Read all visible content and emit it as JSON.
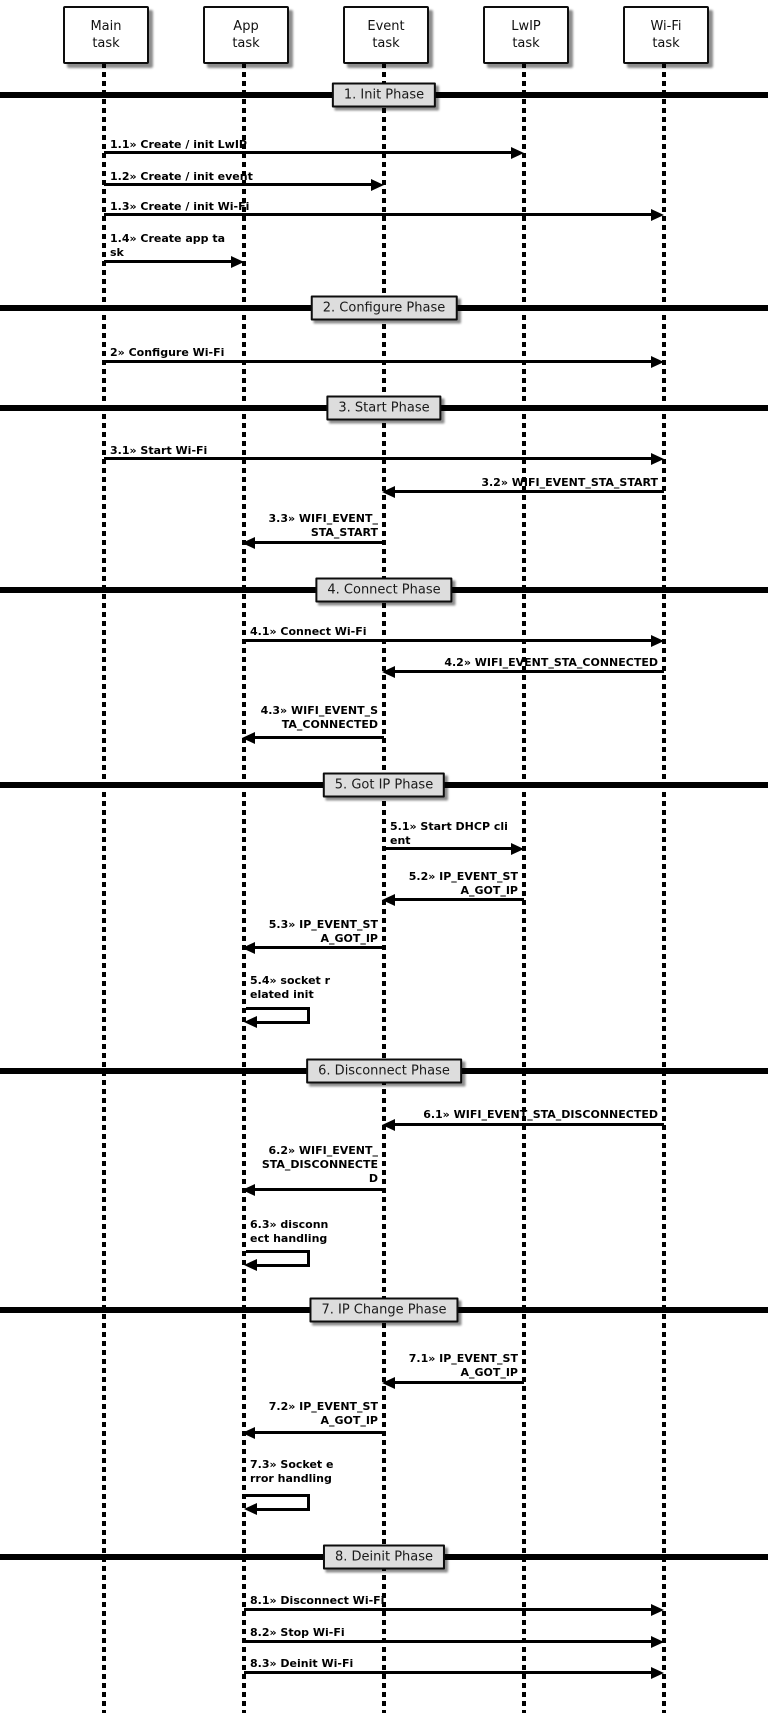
{
  "diagram_type": "uml-sequence-diagram",
  "colors": {
    "line": "#000000",
    "actor_box_bg": "#ffffff",
    "phase_box_bg": "#dddddd",
    "text": "#000000",
    "background": "#ffffff"
  },
  "actors": [
    {
      "id": "main-task",
      "lines": [
        "Main",
        "task"
      ]
    },
    {
      "id": "app-task",
      "lines": [
        "App",
        "task"
      ]
    },
    {
      "id": "event-task",
      "lines": [
        "Event",
        "task"
      ]
    },
    {
      "id": "lwip-task",
      "lines": [
        "LwIP",
        "task"
      ]
    },
    {
      "id": "wifi-task",
      "lines": [
        "Wi-Fi",
        "task"
      ]
    }
  ],
  "phases": [
    {
      "label": "1. Init Phase"
    },
    {
      "label": "2. Configure Phase"
    },
    {
      "label": "3. Start Phase"
    },
    {
      "label": "4. Connect Phase"
    },
    {
      "label": "5. Got IP Phase"
    },
    {
      "label": "6. Disconnect Phase"
    },
    {
      "label": "7. IP Change Phase"
    },
    {
      "label": "8. Deinit Phase"
    }
  ],
  "messages": [
    {
      "num": "1.1",
      "text": "1.1» Create / init LwIP",
      "lines": [
        "1.1» Create / init LwIP"
      ],
      "from": "Main task",
      "to": "LwIP task",
      "kind": "call"
    },
    {
      "num": "1.2",
      "text": "1.2» Create / init event",
      "lines": [
        "1.2» Create / init event"
      ],
      "from": "Main task",
      "to": "Event task",
      "kind": "call"
    },
    {
      "num": "1.3",
      "text": "1.3» Create / init Wi-Fi",
      "lines": [
        "1.3» Create / init Wi-Fi"
      ],
      "from": "Main task",
      "to": "Wi-Fi task",
      "kind": "call"
    },
    {
      "num": "1.4",
      "text": "1.4» Create app task",
      "lines": [
        "1.4» Create app ta",
        "sk"
      ],
      "from": "Main task",
      "to": "App task",
      "kind": "call"
    },
    {
      "num": "2",
      "text": "2» Configure Wi-Fi",
      "lines": [
        "2» Configure Wi-Fi"
      ],
      "from": "Main task",
      "to": "Wi-Fi task",
      "kind": "call"
    },
    {
      "num": "3.1",
      "text": "3.1» Start Wi-Fi",
      "lines": [
        "3.1» Start Wi-Fi"
      ],
      "from": "Main task",
      "to": "Wi-Fi task",
      "kind": "call"
    },
    {
      "num": "3.2",
      "text": "3.2» WIFI_EVENT_STA_START",
      "lines": [
        "3.2» WIFI_EVENT_STA_START"
      ],
      "from": "Wi-Fi task",
      "to": "Event task",
      "kind": "event"
    },
    {
      "num": "3.3",
      "text": "3.3» WIFI_EVENT_STA_START",
      "lines": [
        "3.3» WIFI_EVENT_",
        "STA_START"
      ],
      "from": "Event task",
      "to": "App task",
      "kind": "event"
    },
    {
      "num": "4.1",
      "text": "4.1» Connect Wi-Fi",
      "lines": [
        "4.1» Connect Wi-Fi"
      ],
      "from": "App task",
      "to": "Wi-Fi task",
      "kind": "call"
    },
    {
      "num": "4.2",
      "text": "4.2» WIFI_EVENT_STA_CONNECTED",
      "lines": [
        "4.2» WIFI_EVENT_STA_CONNECTED"
      ],
      "from": "Wi-Fi task",
      "to": "Event task",
      "kind": "event"
    },
    {
      "num": "4.3",
      "text": "4.3» WIFI_EVENT_STA_CONNECTED",
      "lines": [
        "4.3» WIFI_EVENT_S",
        "TA_CONNECTED"
      ],
      "from": "Event task",
      "to": "App task",
      "kind": "event"
    },
    {
      "num": "5.1",
      "text": "5.1» Start DHCP client",
      "lines": [
        "5.1» Start DHCP cli",
        "ent"
      ],
      "from": "Event task",
      "to": "LwIP task",
      "kind": "call"
    },
    {
      "num": "5.2",
      "text": "5.2» IP_EVENT_STA_GOT_IP",
      "lines": [
        "5.2» IP_EVENT_ST",
        "A_GOT_IP"
      ],
      "from": "LwIP task",
      "to": "Event task",
      "kind": "event"
    },
    {
      "num": "5.3",
      "text": "5.3» IP_EVENT_STA_GOT_IP",
      "lines": [
        "5.3» IP_EVENT_ST",
        "A_GOT_IP"
      ],
      "from": "Event task",
      "to": "App task",
      "kind": "event"
    },
    {
      "num": "5.4",
      "text": "5.4» socket related init",
      "lines": [
        "5.4» socket r",
        "elated init"
      ],
      "from": "App task",
      "to": "App task",
      "kind": "self"
    },
    {
      "num": "6.1",
      "text": "6.1» WIFI_EVENT_STA_DISCONNECTED",
      "lines": [
        "6.1» WIFI_EVENT_STA_DISCONNECTED"
      ],
      "from": "Wi-Fi task",
      "to": "Event task",
      "kind": "event"
    },
    {
      "num": "6.2",
      "text": "6.2» WIFI_EVENT_STA_DISCONNECTED",
      "lines": [
        "6.2» WIFI_EVENT_",
        "STA_DISCONNECTE",
        "D"
      ],
      "from": "Event task",
      "to": "App task",
      "kind": "event"
    },
    {
      "num": "6.3",
      "text": "6.3» disconnect handling",
      "lines": [
        "6.3» disconn",
        "ect handling"
      ],
      "from": "App task",
      "to": "App task",
      "kind": "self"
    },
    {
      "num": "7.1",
      "text": "7.1» IP_EVENT_STA_GOT_IP",
      "lines": [
        "7.1» IP_EVENT_ST",
        "A_GOT_IP"
      ],
      "from": "LwIP task",
      "to": "Event task",
      "kind": "event"
    },
    {
      "num": "7.2",
      "text": "7.2» IP_EVENT_STA_GOT_IP",
      "lines": [
        "7.2» IP_EVENT_ST",
        "A_GOT_IP"
      ],
      "from": "Event task",
      "to": "App task",
      "kind": "event"
    },
    {
      "num": "7.3",
      "text": "7.3» Socket error handling",
      "lines": [
        "7.3» Socket e",
        "rror handling"
      ],
      "from": "App task",
      "to": "App task",
      "kind": "self"
    },
    {
      "num": "8.1",
      "text": "8.1» Disconnect Wi-Fi",
      "lines": [
        "8.1» Disconnect Wi-Fi"
      ],
      "from": "App task",
      "to": "Wi-Fi task",
      "kind": "call"
    },
    {
      "num": "8.2",
      "text": "8.2» Stop Wi-Fi",
      "lines": [
        "8.2» Stop Wi-Fi"
      ],
      "from": "App task",
      "to": "Wi-Fi task",
      "kind": "call"
    },
    {
      "num": "8.3",
      "text": "8.3» Deinit Wi-Fi",
      "lines": [
        "8.3» Deinit Wi-Fi"
      ],
      "from": "App task",
      "to": "Wi-Fi task",
      "kind": "call"
    }
  ]
}
